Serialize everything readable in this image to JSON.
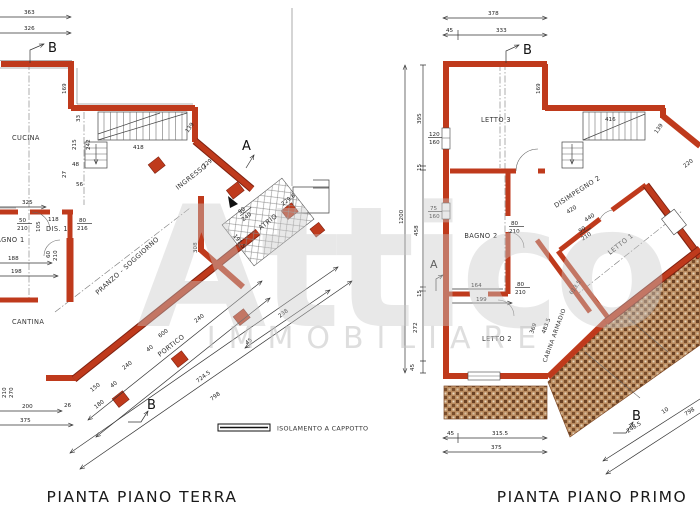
{
  "watermark": {
    "word": "Attico",
    "subword": "IMMOBILIARE"
  },
  "legend": {
    "insulation": "ISOLAMENTO A CAPPOTTO"
  },
  "colors": {
    "wall": "#bf3a1c",
    "wall_dark": "#7e2110",
    "terrace_bg": "#b98a5e",
    "terrace_dot": "#6a4124",
    "line": "#333333",
    "watermark": "#c9c9c9"
  },
  "terra": {
    "title": "PIANTA PIANO TERRA",
    "rooms": {
      "cucina": "CUCINA",
      "ingresso": "INGRESSO",
      "atrio": "ATRIO",
      "bagno1": "BAGNO 1",
      "dis1": "DIS. 1",
      "pranzo": "PRANZO - SOGGIORNO",
      "cantina": "CANTINA",
      "portico": "PORTICO"
    },
    "markers": {
      "b_top": "B",
      "a": "A",
      "b_bottom": "B"
    },
    "dims": {
      "top1": "363",
      "top2": "326",
      "wall_left": "169",
      "step": "33",
      "stair_h": "215",
      "stair_h2": "242",
      "stair_w": "418",
      "stair_d": "139",
      "s48": "48",
      "s27": "27",
      "s56": "56",
      "ingresso_len": "229",
      "atrio_diag": "229.6",
      "atrio_door_w": "90",
      "atrio_door_h": "240",
      "atrio_side": "191.5",
      "bagno_top": "325",
      "win_w": "50",
      "win_h": "210",
      "d105": "105",
      "dis_w": "118",
      "door_w": "80",
      "door_h": "216",
      "door2_w": "60",
      "door2_h": "210",
      "bagno_w1": "188",
      "bagno_w2": "198",
      "pranzo_l": "308",
      "cant_win1": "210",
      "cant_win2": "270",
      "bot1": "200",
      "bot2": "26",
      "bot3": "375",
      "p150": "150",
      "p180": "180",
      "p40a": "40",
      "p240a": "240",
      "p40b": "40",
      "p600": "600",
      "p240b": "240",
      "p45": "45",
      "p238": "238",
      "p724": "724.5",
      "p798": "798"
    }
  },
  "primo": {
    "title": "PIANTA PIANO PRIMO",
    "rooms": {
      "letto3": "LETTO 3",
      "bagno2": "BAGNO 2",
      "disimpegno2": "DISIMPEGNO 2",
      "letto1": "LETTO 1",
      "letto2": "LETTO 2",
      "cabina": "CABINA ARMADIO"
    },
    "markers": {
      "b_top": "B",
      "a": "A",
      "b_bottom": "B"
    },
    "dims": {
      "top1": "378",
      "top2": "45",
      "top3": "333",
      "total_h": "1200",
      "h1": "395",
      "h2": "15",
      "h3": "458",
      "h4": "15",
      "h5": "272",
      "h6": "45",
      "win1_w": "120",
      "win1_h": "160",
      "win2_w": "75",
      "win2_h": "160",
      "wall_right": "169",
      "stair_w": "416",
      "stair_d": "139",
      "diag_r": "220",
      "door_bagno_w": "80",
      "door_bagno_h": "210",
      "dis_l": "420",
      "dis_l2": "440",
      "door_letto1_w": "90",
      "door_letto1_h": "210",
      "d164": "164",
      "d199": "199",
      "door_cab_w": "80",
      "door_cab_h": "210",
      "cab_l": "483.5",
      "cab_w": "369",
      "letto1_l": "613.5",
      "bot1": "45",
      "bot2": "315.5",
      "bot3": "375",
      "diag1": "248.5",
      "diag2": "10",
      "diag3": "798"
    }
  }
}
